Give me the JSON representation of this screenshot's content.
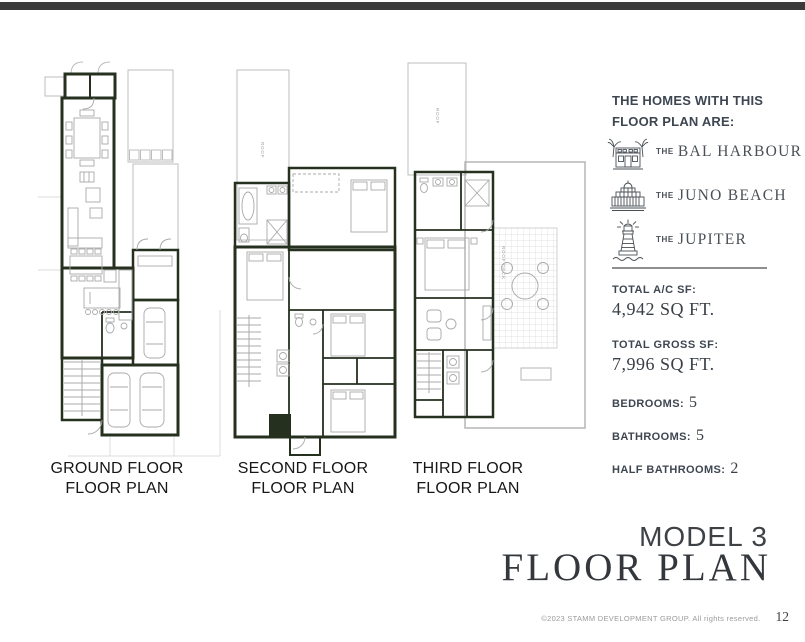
{
  "floor_plans": [
    {
      "title_line1": "GROUND FLOOR",
      "title_line2": "FLOOR PLAN"
    },
    {
      "title_line1": "SECOND FLOOR",
      "title_line2": "FLOOR PLAN"
    },
    {
      "title_line1": "THIRD FLOOR",
      "title_line2": "FLOOR PLAN"
    }
  ],
  "plan_annotations": {
    "roof_strip": "ROOF",
    "roof_deck": "ROOF DECK"
  },
  "info_panel": {
    "heading_line1": "THE HOMES WITH THIS",
    "heading_line2": "FLOOR PLAN ARE:",
    "homes": [
      {
        "prefix": "THE",
        "name": "BAL HARBOUR",
        "icon": "house-with-palms-icon"
      },
      {
        "prefix": "THE",
        "name": "JUNO BEACH",
        "icon": "beach-pavilion-icon"
      },
      {
        "prefix": "THE",
        "name": "JUPITER",
        "icon": "lighthouse-icon"
      }
    ],
    "stats_block": [
      {
        "label": "TOTAL A/C SF:",
        "value": "4,942 SQ FT."
      },
      {
        "label": "TOTAL GROSS SF:",
        "value": "7,996 SQ FT."
      }
    ],
    "stats_inline": [
      {
        "label": "BEDROOMS:",
        "value": "5"
      },
      {
        "label": "BATHROOMS:",
        "value": "5"
      },
      {
        "label": "HALF BATHROOMS:",
        "value": "2"
      }
    ]
  },
  "title_block": {
    "model": "MODEL 3",
    "title": "FLOOR PLAN"
  },
  "footer": {
    "copyright": "©2023 STAMM DEVELOPMENT GROUP.  All rights reserved.",
    "page_number": "12"
  },
  "colors": {
    "top_bar": "#3b3b3b",
    "wall_ink": "#25301f",
    "light_line": "#bdbdbd",
    "panel_text": "#3d4651",
    "serif_text": "#394047"
  }
}
